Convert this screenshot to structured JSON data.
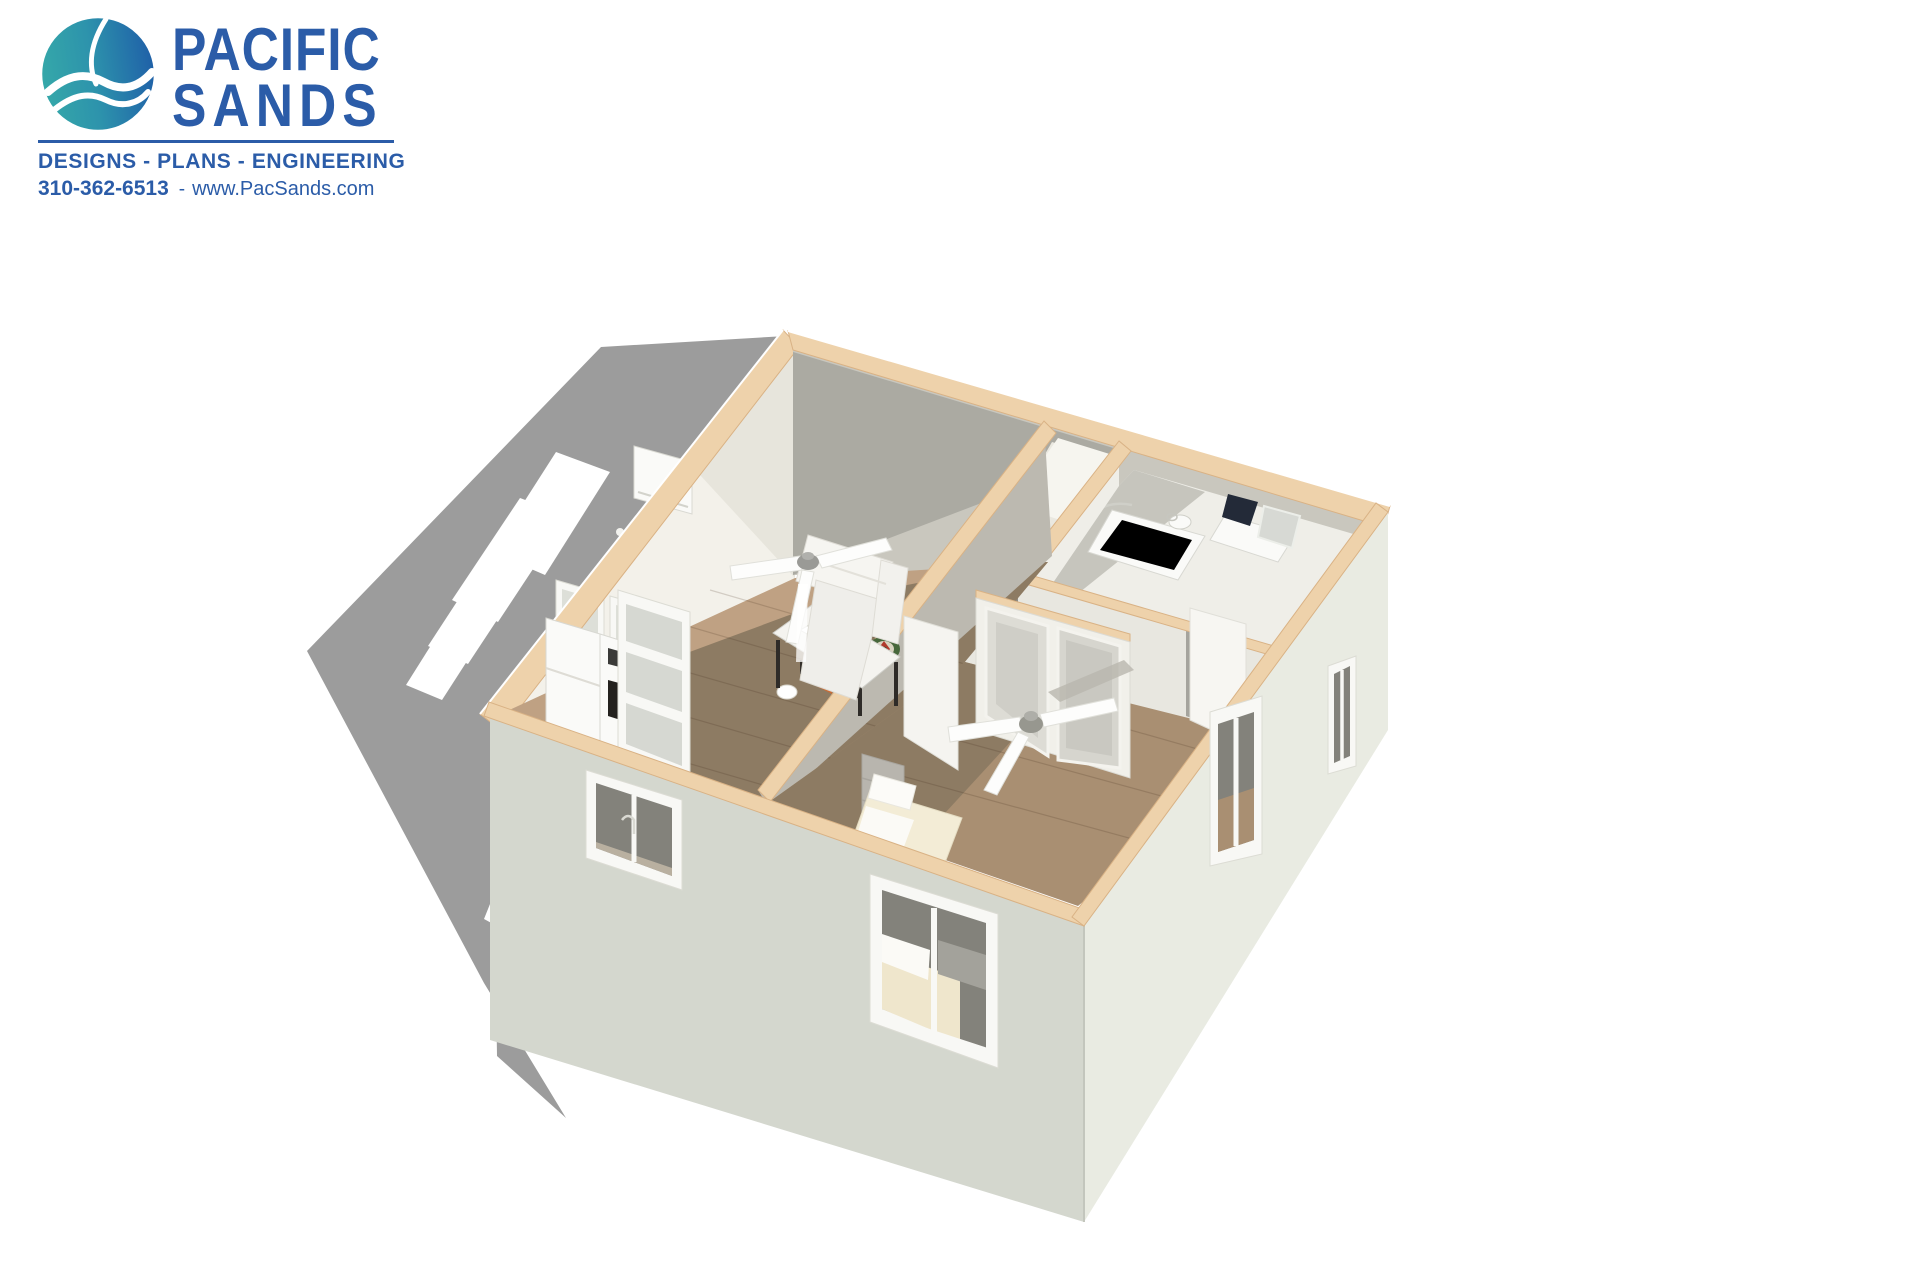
{
  "logo": {
    "name_line1": "PACIFIC",
    "name_line2": "SANDS",
    "tagline": "DESIGNS - PLANS - ENGINEERING",
    "phone": "310-362-6513",
    "separator": "-",
    "website": "www.PacSands.com"
  },
  "colors": {
    "brand_blue": "#2b5ca8",
    "brand_teal": "#2f9fae",
    "shadow_gray": "#9c9c9c",
    "band_tan": "#eed2ab",
    "band_edge": "#d9b285",
    "ext_left": "#d4d7ce",
    "ext_right": "#e9ebe2",
    "wall_gray": "#c9c7be",
    "wall_shadow": "#abaaa2",
    "wall_white": "#f3f1ea",
    "wood_light": "#bfa183",
    "wood_dark": "#8d7b63",
    "wood_mid": "#a98f72",
    "floor_light": "#efeee8",
    "fixture_white": "#fafaf8",
    "appliance_dark": "#23211e",
    "dartboard_green": "#4a6b3a",
    "dartboard_red": "#b23b2e"
  },
  "scene": {
    "type": "3d-cutaway-floor-plan-rendering",
    "rooms": [
      "living-room",
      "kitchen",
      "bathroom",
      "closet",
      "bedroom"
    ]
  }
}
